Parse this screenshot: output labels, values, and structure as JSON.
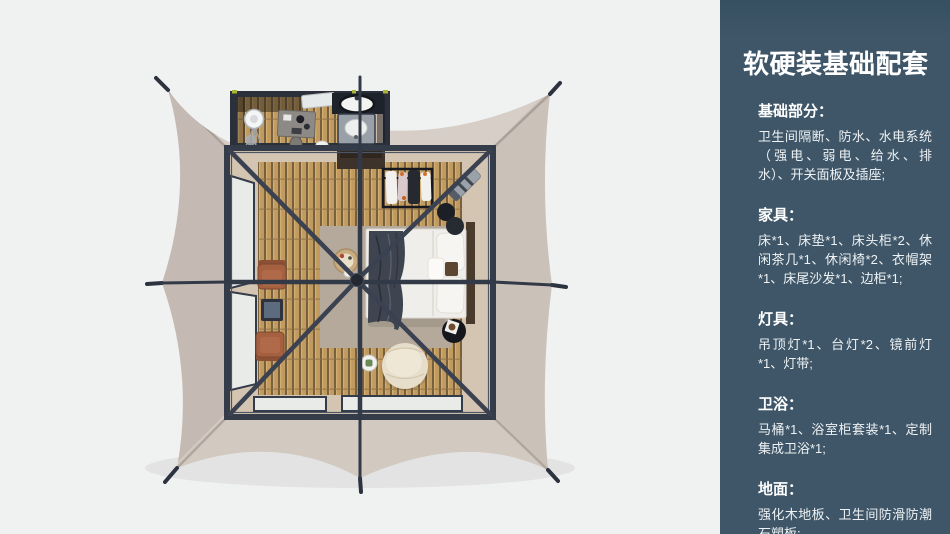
{
  "page": {
    "background": "#f0f1f1"
  },
  "panel": {
    "title": "软硬装基础配套",
    "sections": [
      {
        "heading": "基础部分：",
        "body": "卫生间隔断、防水、水电系统（强电、弱电、给水、排水）、开关面板及插座;"
      },
      {
        "heading": "家具：",
        "body": "床*1、床垫*1、床头柜*2、休闲茶几*1、休闲椅*2、衣帽架*1、床尾沙发*1、边柜*1;"
      },
      {
        "heading": "灯具：",
        "body": "吊顶灯*1、台灯*2、镜前灯*1、灯带;"
      },
      {
        "heading": "卫浴：",
        "body": "马桶*1、浴室柜套装*1、定制集成卫浴*1;"
      },
      {
        "heading": "地面：",
        "body": "强化木地板、卫生间防滑防潮石塑板;"
      }
    ]
  },
  "colors": {
    "page-bg": "#f0f1f1",
    "panel-bg": "#3e5668",
    "panel-text": "#ffffff",
    "tent-canvas": "#cfc5bd",
    "frame": "#343b49",
    "wood-plank": "#c19a5f",
    "wood-gap": "#77603e",
    "interior-floor": "#d4c5b3",
    "rug": "#b5a99b",
    "bed-linen": "#efeeeb",
    "blanket": "#3f4451",
    "lounge-chair": "#a4603f",
    "ottoman": "#e7ddcb"
  }
}
